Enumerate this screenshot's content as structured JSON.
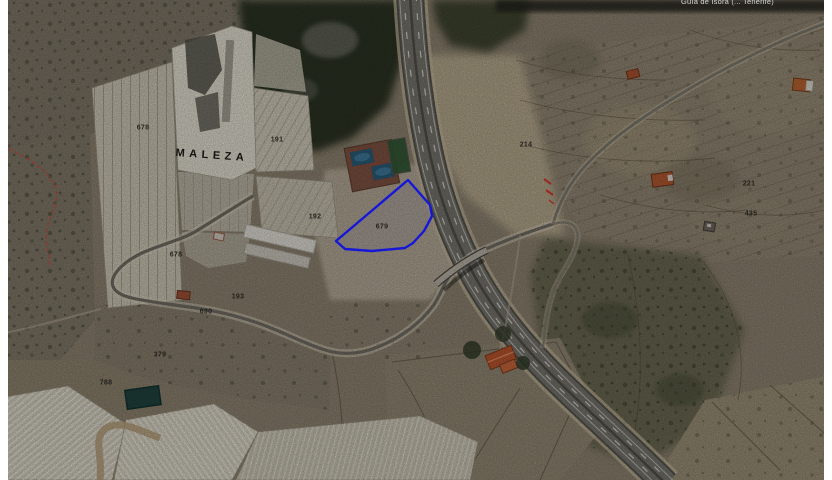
{
  "map": {
    "type": "aerial-cadastral-parcel-view",
    "attribution_partial": "Guía de Isora (... Tenerife)",
    "place_name": "MALEZA",
    "highlighted_parcel": {
      "number": "679",
      "outline_color": "#1717d8"
    },
    "boundary_line_color": "#c6493f",
    "parcel_labels": [
      {
        "text": "678"
      },
      {
        "text": "191"
      },
      {
        "text": "192"
      },
      {
        "text": "679"
      },
      {
        "text": "678"
      },
      {
        "text": "193"
      },
      {
        "text": "690"
      },
      {
        "text": "379"
      },
      {
        "text": "788"
      },
      {
        "text": "214"
      },
      {
        "text": "221"
      },
      {
        "text": "435"
      }
    ],
    "colors": {
      "terrain_base": "#897f6d",
      "highway_asphalt": "#73716a",
      "field_light": "#dcd8cb",
      "water_tank": "#2a5a74",
      "vegetation_dark": "#2c3122"
    }
  }
}
